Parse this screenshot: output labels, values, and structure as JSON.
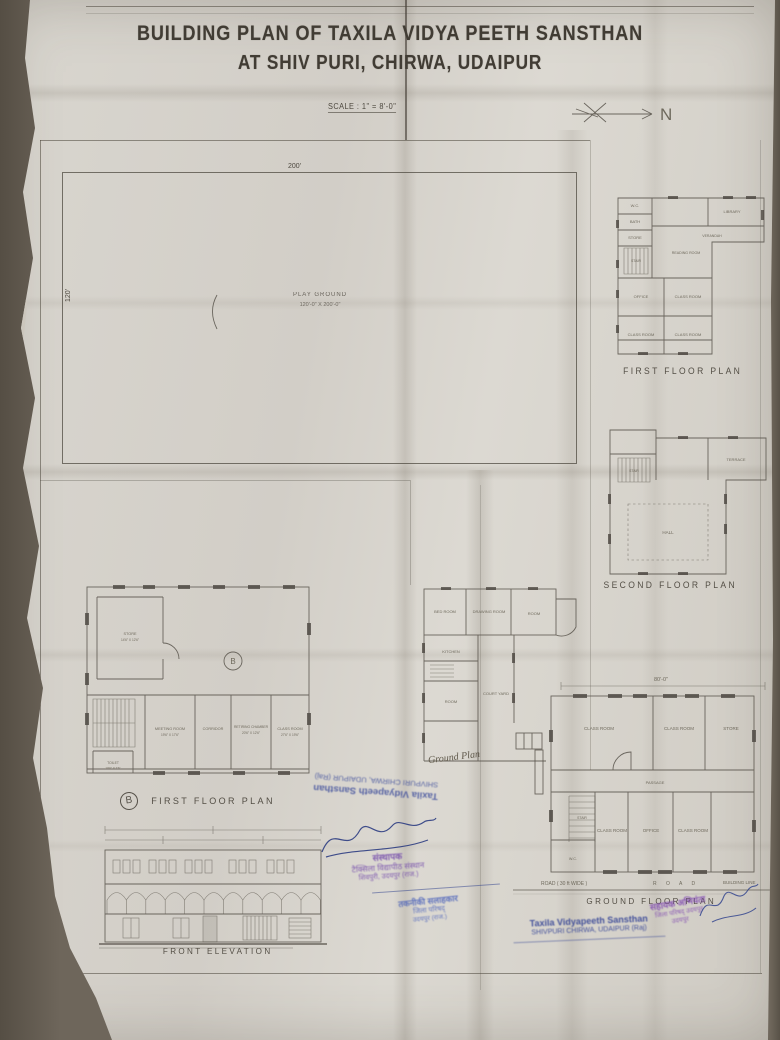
{
  "title": {
    "line1": "BUILDING PLAN OF TAXILA VIDYA PEETH SANSTHAN",
    "line2": "AT SHIV PURI, CHIRWA, UDAIPUR"
  },
  "scale_note": "SCALE : 1\" = 8'-0\"",
  "north": {
    "label": "N"
  },
  "site_plan": {
    "dim_top": "200'",
    "dim_left": "120'",
    "name": "PLAY GROUND",
    "size": "120'-0\" X 200'-0\""
  },
  "plan_first_right": {
    "label": "FIRST FLOOR PLAN",
    "rooms": {
      "wc": "W.C.",
      "bath": "BATH",
      "store": "STORE",
      "stair": "STAIR",
      "library": "LIBRARY",
      "verandah": "VERANDAH",
      "reading": "READING ROOM",
      "office": "OFFICE",
      "class1": "CLASS ROOM",
      "class2": "CLASS ROOM",
      "class3": "CLASS ROOM"
    }
  },
  "plan_second_right": {
    "label": "SECOND FLOOR PLAN",
    "rooms": {
      "terrace": "TERRACE",
      "hall": "HALL",
      "stair": "STAIR"
    }
  },
  "plan_ground_right": {
    "label": "GROUND FLOOR PLAN",
    "dim_top": "80'-0\"",
    "road_left": "ROAD ( 30 ft WIDE )",
    "road_center": "R O A D",
    "road_right": "BUILDING LINE",
    "rooms": {
      "class1": "CLASS ROOM",
      "class2": "CLASS ROOM",
      "store": "STORE",
      "passage": "PASSAGE",
      "class3": "CLASS ROOM",
      "office": "OFFICE",
      "class4": "CLASS ROOM",
      "stair": "STAIR",
      "toilet": "W.C."
    }
  },
  "plan_middle": {
    "handwritten": "Ground Plan",
    "rooms": {
      "bed": "BED ROOM",
      "drawing": "DRAWING ROOM",
      "room1": "ROOM",
      "kitchen": "KITCHEN",
      "room2": "ROOM",
      "court": "COURT YARD"
    }
  },
  "plan_first_left": {
    "badge": "B",
    "label": "FIRST FLOOR PLAN",
    "rooms": {
      "store": {
        "name": "STORE",
        "size": "14'6\" X 12'6\""
      },
      "meeting": {
        "name": "MEETING ROOM",
        "size": "19'6\" X 17'6\""
      },
      "corridor": {
        "name": "CORRIDOR",
        "size": ""
      },
      "retiring": {
        "name": "RETIRING CHAMBER",
        "size": "20'6\" X 12'6\""
      },
      "class": {
        "name": "CLASS ROOM",
        "size": "27'6\" X 19'6\""
      },
      "toilet": {
        "name": "TOILET",
        "size": "10'6\" X 7'6\""
      }
    }
  },
  "elevation": {
    "label": "FRONT ELEVATION"
  },
  "stamps": {
    "inverted": {
      "line1": "Taxila Vidyapeeth Sansthan",
      "line2": "SHIVPURI CHIRWA, UDAIPUR (Raj)"
    },
    "founder": {
      "line1": "संस्थापक",
      "line2": "टैक्सिला विद्यापीठ संस्थान",
      "line3": "शिवपुरी, उदयपुर (राज.)"
    },
    "advisor": {
      "line1": "तकनीकी सलाहकार",
      "line2": "जिला परिषद्",
      "line3": "उदयपुर (राज.)"
    },
    "bottom": {
      "line1": "Taxila Vidyapeeth Sansthan",
      "line2": "SHIVPURI CHIRWA, UDAIPUR (Raj)"
    },
    "engineer": {
      "line1": "सहायक अभियंता",
      "line2": "जिला परिषद् उदयपुर",
      "line3": "उदयपुर"
    }
  },
  "colors": {
    "paper": "#d7d3cb",
    "desk": "#6b635a",
    "ink_pencil": "#4d483f",
    "stamp_blue": "#2f3f94",
    "stamp_purple": "#6b3fa8"
  }
}
